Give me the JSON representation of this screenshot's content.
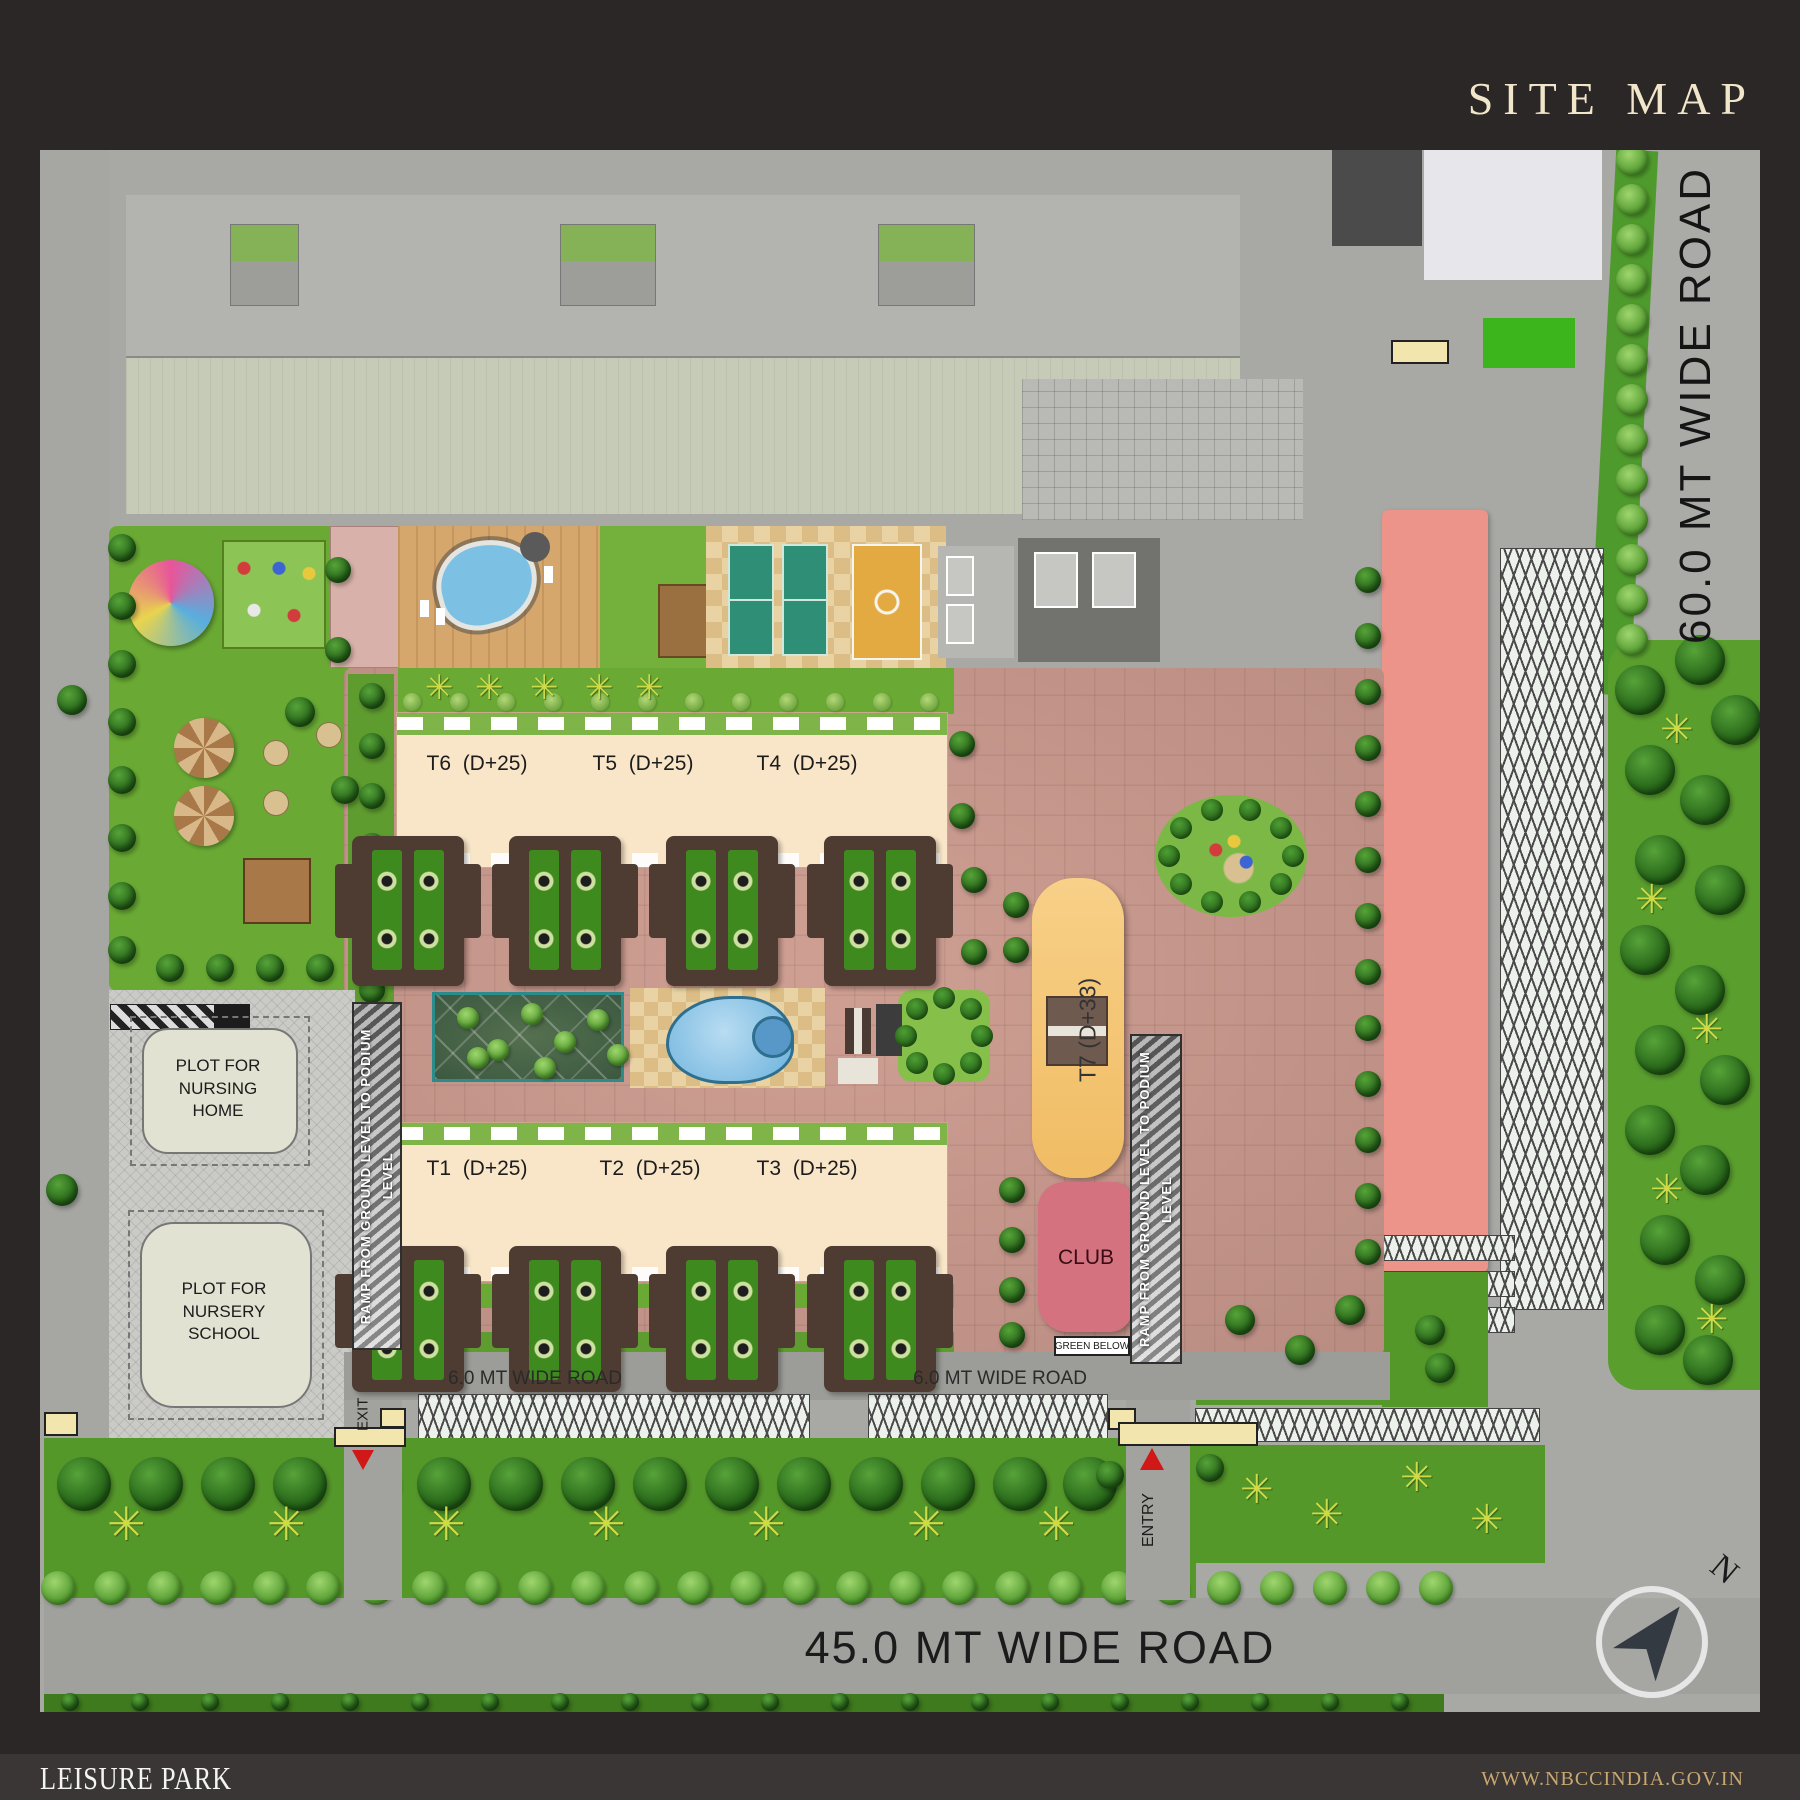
{
  "title": "SITE MAP",
  "roads": {
    "right": "60.0 MT WIDE ROAD",
    "bottom": "45.0 MT WIDE ROAD",
    "internal_west": "6.0 MT WIDE ROAD",
    "internal_east": "6.0 MT WIDE ROAD"
  },
  "towers": [
    {
      "label": "T6  (D+25)"
    },
    {
      "label": "T5  (D+25)"
    },
    {
      "label": "T4  (D+25)"
    },
    {
      "label": "T1  (D+25)"
    },
    {
      "label": "T2  (D+25)"
    },
    {
      "label": "T3  (D+25)"
    },
    {
      "label": "T7 (D+33)"
    }
  ],
  "club": "CLUB",
  "green_below": "GREEN BELOW",
  "plots": {
    "nursing": "PLOT FOR NURSING HOME",
    "nursery": "PLOT FOR NURSERY SCHOOL"
  },
  "ramp_west": "RAMP FROM GROUND LEVEL TO PODIUM LEVEL",
  "ramp_east": "RAMP FROM GROUND LEVEL TO PODIUM LEVEL",
  "gates": {
    "entry": "ENTRY",
    "exit": "EXIT"
  },
  "compass_north": "N",
  "footer": {
    "project": "LEISURE PARK",
    "website": "WWW.NBCCINDIA.GOV.IN"
  },
  "colors": {
    "frame": "#2b2726",
    "accent_text": "#f1e6ca",
    "podium": "#c0968b",
    "lawn": "#6aaa34",
    "pool": "#8ec6e8",
    "tower": "#f9e6c9",
    "t7": "#f5c878",
    "club": "#d4737f",
    "pink_strip": "#ec938a"
  }
}
